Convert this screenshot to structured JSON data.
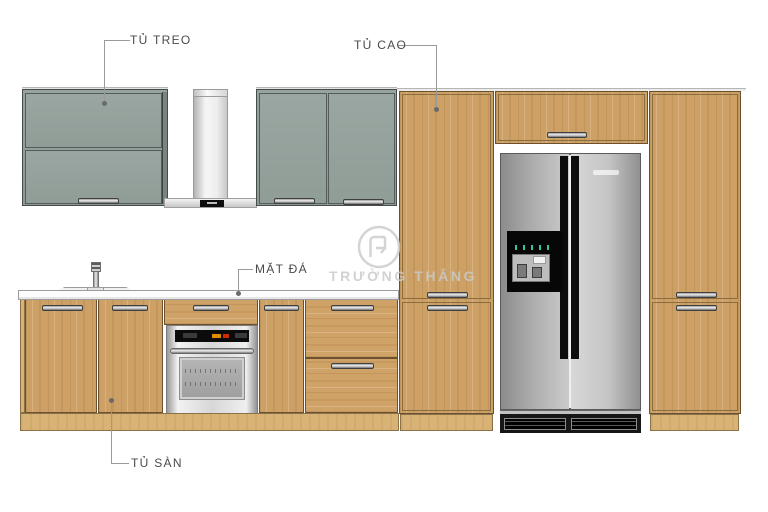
{
  "diagram": {
    "type": "kitchen-elevation-drawing",
    "annotations": [
      {
        "id": "tu-treo",
        "label": "TỦ TREO",
        "points_to": "wall-hung-cabinet"
      },
      {
        "id": "tu-cao",
        "label": "TỦ CAO",
        "points_to": "tall-cabinet"
      },
      {
        "id": "mat-da",
        "label": "MẶT ĐÁ",
        "points_to": "stone-countertop"
      },
      {
        "id": "tu-san",
        "label": "TỦ SÀN",
        "points_to": "base-cabinet"
      }
    ],
    "watermark": {
      "text": "TRƯỜNG THẮNG",
      "logo_icon": "truong-thang-monogram-icon"
    },
    "appliances": [
      "range-hood",
      "built-in-oven",
      "side-by-side-refrigerator",
      "sink-faucet"
    ],
    "palette": {
      "wood": "#cda065",
      "wood_toekick": "#d9b276",
      "cabinet_gray": "#94a09b",
      "outline_dark": "#6b5130",
      "stainless": "#c6c6c6",
      "appliance_black": "#111111",
      "countertop": "#fcfcfc",
      "label_text": "#4a4a4a",
      "leader_line": "#9a9a9a",
      "watermark_gray": "#c9cccb",
      "oven_display_orange": "#e58900",
      "oven_display_red": "#cf2b00",
      "dispenser_led_teal": "#39c2a0"
    }
  }
}
